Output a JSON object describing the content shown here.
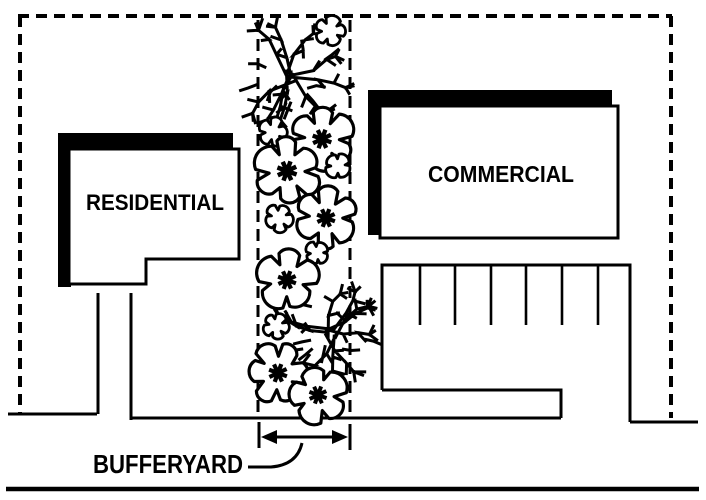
{
  "figure": {
    "type": "zoning-bufferyard-site-plan",
    "labels": {
      "residential_zone": "RESIDENTIAL",
      "commercial_zone": "COMMERCIAL",
      "buffer_label": "BUFFERYARD"
    },
    "colors": {
      "ink": "#000000",
      "paper": "#ffffff"
    },
    "buffer_strip": {
      "left_x": 258,
      "right_x": 350
    },
    "plantings": [
      {
        "type": "shrub",
        "x": 292,
        "y": 76,
        "r": 47,
        "seed": 11
      },
      {
        "type": "shrub",
        "x": 331,
        "y": 332,
        "r": 45,
        "seed": 29
      },
      {
        "type": "cloud",
        "x": 330,
        "y": 31,
        "r": 14,
        "lobes": 5,
        "seed": 3
      },
      {
        "type": "cloud",
        "x": 273,
        "y": 132,
        "r": 13,
        "lobes": 5,
        "seed": 4
      },
      {
        "type": "canopy",
        "x": 322,
        "y": 139,
        "r": 29,
        "lobes": 6,
        "seed": 5
      },
      {
        "type": "canopy",
        "x": 287,
        "y": 171,
        "r": 30,
        "lobes": 6,
        "seed": 6
      },
      {
        "type": "cloud",
        "x": 338,
        "y": 166,
        "r": 12,
        "lobes": 4,
        "seed": 7
      },
      {
        "type": "cloud",
        "x": 279,
        "y": 218,
        "r": 13,
        "lobes": 5,
        "seed": 8
      },
      {
        "type": "canopy",
        "x": 326,
        "y": 218,
        "r": 28,
        "lobes": 6,
        "seed": 9
      },
      {
        "type": "cloud",
        "x": 317,
        "y": 253,
        "r": 11,
        "lobes": 4,
        "seed": 10
      },
      {
        "type": "canopy",
        "x": 287,
        "y": 280,
        "r": 28,
        "lobes": 5,
        "seed": 12
      },
      {
        "type": "cloud",
        "x": 276,
        "y": 326,
        "r": 12,
        "lobes": 5,
        "seed": 13
      },
      {
        "type": "canopy",
        "x": 278,
        "y": 373,
        "r": 28,
        "lobes": 6,
        "seed": 14
      },
      {
        "type": "canopy",
        "x": 318,
        "y": 395,
        "r": 27,
        "lobes": 5,
        "seed": 15
      }
    ]
  }
}
